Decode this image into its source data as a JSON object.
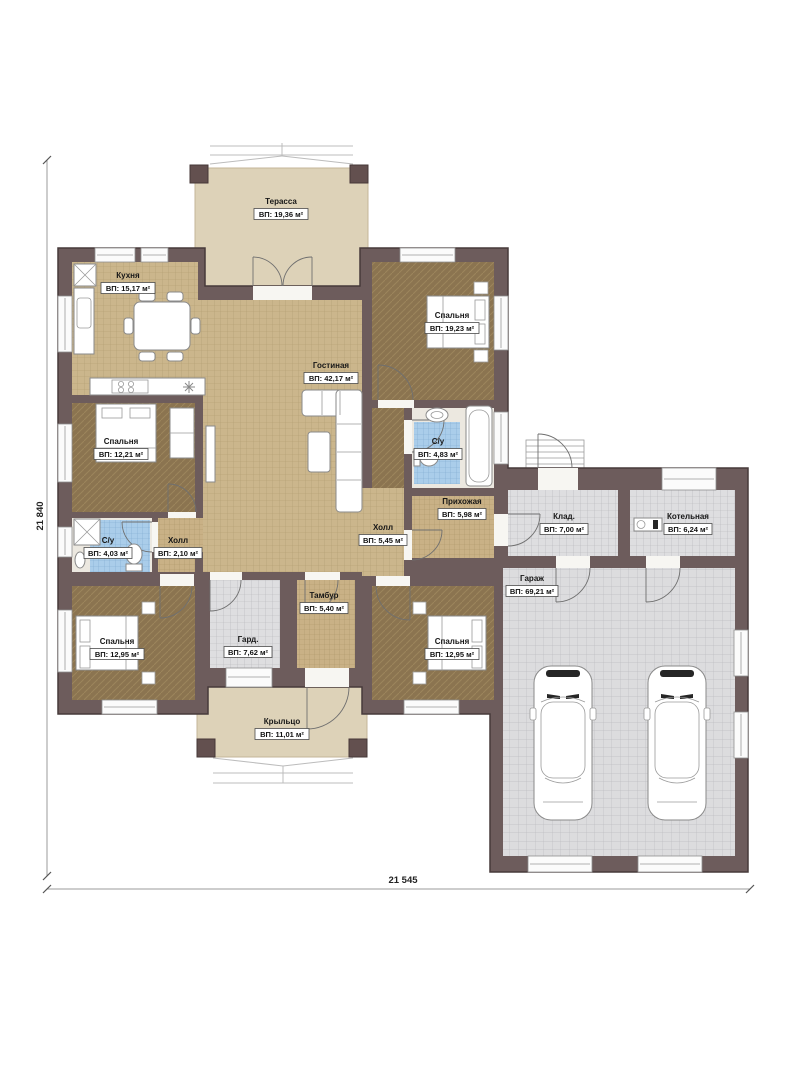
{
  "dimensions": {
    "left": "21 840",
    "bottom": "21 545"
  },
  "rooms": {
    "terrace": {
      "name": "Терасса",
      "area": "ВП: 19,36 м²"
    },
    "kitchen": {
      "name": "Кухня",
      "area": "ВП: 15,17 м²"
    },
    "bedroom_top_right": {
      "name": "Спальня",
      "area": "ВП: 19,23 м²"
    },
    "living": {
      "name": "Гостиная",
      "area": "ВП: 42,17 м²"
    },
    "bedroom_left": {
      "name": "Спальня",
      "area": "ВП: 12,21 м²"
    },
    "bath_right": {
      "name": "С/у",
      "area": "ВП: 4,83 м²"
    },
    "hallway": {
      "name": "Прихожая",
      "area": "ВП: 5,98 м²"
    },
    "storage": {
      "name": "Клад.",
      "area": "ВП: 7,00 м²"
    },
    "boiler": {
      "name": "Котельная",
      "area": "ВП: 6,24 м²"
    },
    "hall_big": {
      "name": "Холл",
      "area": "ВП: 5,45 м²"
    },
    "hall_small": {
      "name": "Холл",
      "area": "ВП: 2,10 м²"
    },
    "bath_left": {
      "name": "С/у",
      "area": "ВП: 4,03 м²"
    },
    "garage": {
      "name": "Гараж",
      "area": "ВП: 69,21 м²"
    },
    "tambour": {
      "name": "Тамбур",
      "area": "ВП: 5,40 м²"
    },
    "wardrobe": {
      "name": "Гард.",
      "area": "ВП: 7,62 м²"
    },
    "bedroom_bottom_left": {
      "name": "Спальня",
      "area": "ВП: 12,95 м²"
    },
    "bedroom_bottom_right": {
      "name": "Спальня",
      "area": "ВП: 12,95 м²"
    },
    "porch": {
      "name": "Крыльцо",
      "area": "ВП: 11,01 м²"
    }
  },
  "colors": {
    "wall": "#6d5c5c",
    "floor_tile": "#cbb68c",
    "floor_bedroom": "#8b7450",
    "bath_tile": "#aacdea",
    "utility_tile": "#dedee0",
    "outdoor": "#ddd2b8"
  }
}
